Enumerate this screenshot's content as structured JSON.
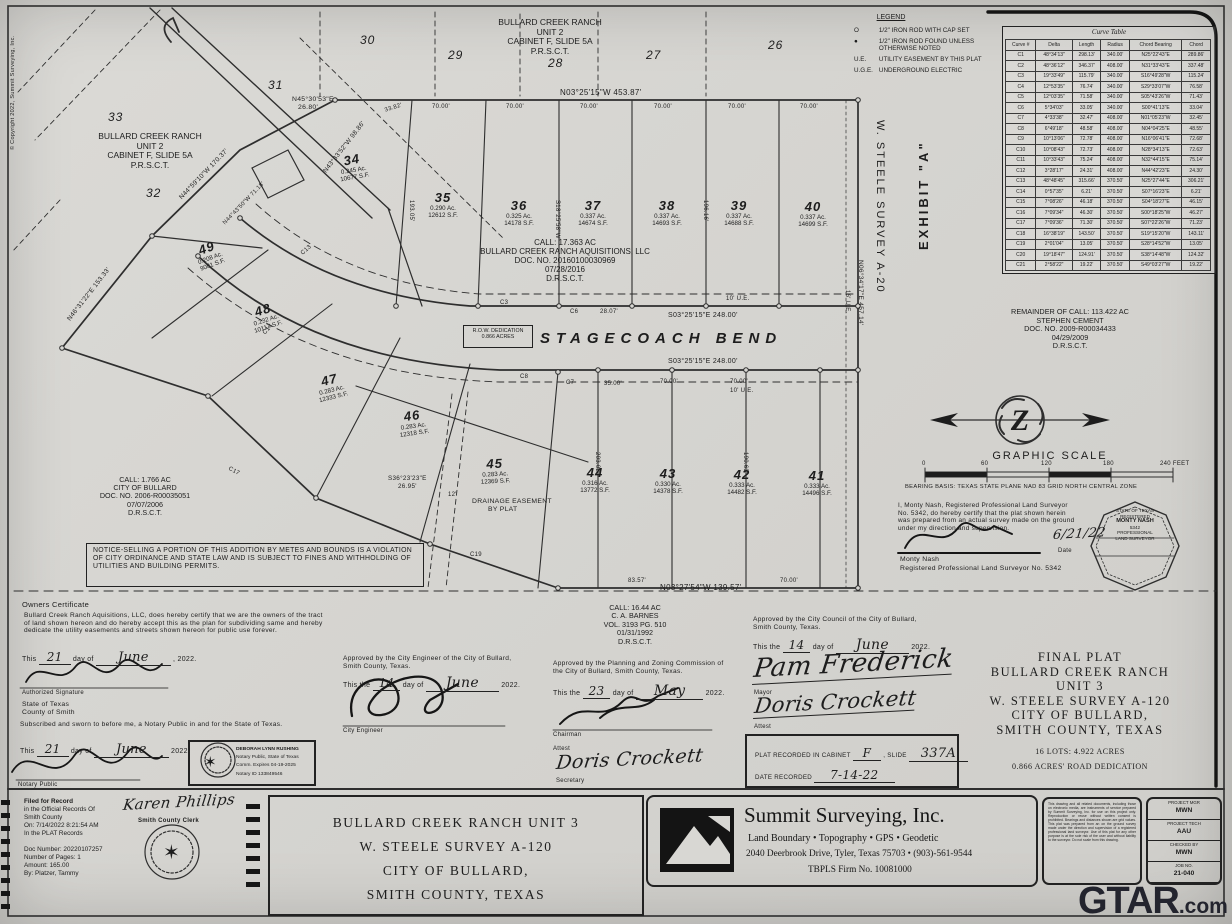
{
  "sheet": {
    "watermark_g": "GTAR",
    "watermark_dot": ".com",
    "copyright": "© Copyright 2022, Summit Surveying, Inc.",
    "exhibit": "EXHIBIT \"A\"",
    "survey": "W.  STEELE  SURVEY  A-20",
    "compass_letter": "Z"
  },
  "legend": {
    "title": "LEGEND",
    "rows": [
      [
        "O",
        "1/2\" IRON ROD WITH CAP SET"
      ],
      [
        "●",
        "1/2\" IRON ROD FOUND UNLESS OTHERWISE NOTED"
      ],
      [
        "U.E.",
        "UTILITY EASEMENT BY THIS PLAT"
      ],
      [
        "U.G.E.",
        "UNDERGROUND ELECTRIC"
      ]
    ]
  },
  "curve_table": {
    "title": "Curve Table",
    "headers": [
      "Curve #",
      "Delta",
      "Length",
      "Radius",
      "Chord Bearing",
      "Chord"
    ],
    "rows": [
      [
        "C1",
        "48°34'13\"",
        "298.13'",
        "340.00'",
        "N25°22'43\"E",
        "289.86'"
      ],
      [
        "C2",
        "48°36'12\"",
        "346.37'",
        "408.00'",
        "N31°33'43\"E",
        "337.48'"
      ],
      [
        "C3",
        "19°33'49\"",
        "115.79'",
        "340.00'",
        "S16°49'28\"W",
        "115.24'"
      ],
      [
        "C4",
        "12°53'35\"",
        "76.74'",
        "340.00'",
        "S29°33'07\"W",
        "76.58'"
      ],
      [
        "C5",
        "12°03'35\"",
        "71.58'",
        "340.00'",
        "S05°43'26\"W",
        "71.43'"
      ],
      [
        "C6",
        "5°34'03\"",
        "33.05'",
        "340.00'",
        "S00°41'13\"E",
        "33.04'"
      ],
      [
        "C7",
        "4°33'38\"",
        "32.47'",
        "408.00'",
        "N01°05'23\"W",
        "32.45'"
      ],
      [
        "C8",
        "6°49'18\"",
        "48.58'",
        "408.00'",
        "N04°04'25\"E",
        "48.55'"
      ],
      [
        "C9",
        "10°13'06\"",
        "72.78'",
        "408.00'",
        "N16°06'41\"E",
        "72.68'"
      ],
      [
        "C10",
        "10°08'43\"",
        "72.73'",
        "408.00'",
        "N28°34'13\"E",
        "72.63'"
      ],
      [
        "C11",
        "10°33'43\"",
        "75.24'",
        "408.00'",
        "N32°44'15\"E",
        "75.14'"
      ],
      [
        "C12",
        "3°28'17\"",
        "24.31'",
        "408.00'",
        "N44°42'23\"E",
        "24.30'"
      ],
      [
        "C13",
        "48°48'45\"",
        "315.66'",
        "370.50'",
        "N25°27'44\"E",
        "306.21'"
      ],
      [
        "C14",
        "0°57'35\"",
        "6.21'",
        "370.50'",
        "S07°16'23\"E",
        "6.21'"
      ],
      [
        "C15",
        "7°08'26\"",
        "46.18'",
        "370.50'",
        "S04°18'27\"E",
        "46.15'"
      ],
      [
        "C16",
        "7°09'34\"",
        "46.30'",
        "370.50'",
        "S00°18'25\"W",
        "46.27'"
      ],
      [
        "C17",
        "7°09'36\"",
        "71.30'",
        "370.50'",
        "S07°22'26\"W",
        "71.23'"
      ],
      [
        "C18",
        "16°38'19\"",
        "143.50'",
        "370.50'",
        "S19°15'20\"W",
        "143.11'"
      ],
      [
        "C19",
        "2°01'04\"",
        "13.05'",
        "370.50'",
        "S28°14'52\"W",
        "13.05'"
      ],
      [
        "C20",
        "19°18'47\"",
        "124.91'",
        "370.50'",
        "S38°14'48\"W",
        "124.32'"
      ],
      [
        "C21",
        "2°58'22\"",
        "19.22'",
        "370.50'",
        "S49°03'27\"W",
        "19.22'"
      ]
    ]
  },
  "unit2": {
    "name": "BULLARD CREEK RANCH",
    "unit": "UNIT 2",
    "cab": "CABINET F, SLIDE 5A",
    "rec": "P.R.S.C.T.",
    "lots": {
      "l26": "26",
      "l27": "27",
      "l28": "28",
      "l29": "29",
      "l30": "30",
      "l31": "31",
      "l32": "32",
      "l33": "33"
    }
  },
  "lots": [
    {
      "num": "34",
      "ac": "0.245 Ac.",
      "sf": "10677 S.F."
    },
    {
      "num": "35",
      "ac": "0.290 Ac.",
      "sf": "12612 S.F."
    },
    {
      "num": "36",
      "ac": "0.325 Ac.",
      "sf": "14178 S.F."
    },
    {
      "num": "37",
      "ac": "0.337 Ac.",
      "sf": "14674 S.F."
    },
    {
      "num": "38",
      "ac": "0.337 Ac.",
      "sf": "14693 S.F."
    },
    {
      "num": "39",
      "ac": "0.337 Ac.",
      "sf": "14688 S.F."
    },
    {
      "num": "40",
      "ac": "0.337 Ac.",
      "sf": "14699 S.F."
    },
    {
      "num": "41",
      "ac": "0.333 Ac.",
      "sf": "14496 S.F."
    },
    {
      "num": "42",
      "ac": "0.333 Ac.",
      "sf": "14482 S.F."
    },
    {
      "num": "43",
      "ac": "0.330 Ac.",
      "sf": "14378 S.F."
    },
    {
      "num": "44",
      "ac": "0.316 Ac.",
      "sf": "13772 S.F."
    },
    {
      "num": "45",
      "ac": "0.283 Ac.",
      "sf": "12369 S.F."
    },
    {
      "num": "46",
      "ac": "0.283 Ac.",
      "sf": "12318 S.F."
    },
    {
      "num": "47",
      "ac": "0.283 Ac.",
      "sf": "12333 S.F."
    },
    {
      "num": "48",
      "ac": "0.232 Ac.",
      "sf": "10117 S.F."
    },
    {
      "num": "49",
      "ac": "0.208 Ac.",
      "sf": "9081 S.F."
    }
  ],
  "street": {
    "name": "STAGECOACH  BEND",
    "row1": "R.O.W. DEDICATION",
    "row2": "0.866 ACRES"
  },
  "bearings": {
    "top": "N03°25'15\"W   453.87'",
    "bottom": "N03°27'54\"W   139.57'",
    "street_n": "S03°25'15\"E   248.00'",
    "street_s": "S03°25'15\"E   248.00'",
    "east": "N06°34'17\"E   457.14'",
    "ne1": "N45°30'53\"E",
    "ne1l": "26.80'",
    "nw1": "N43°33'52\"W  98.86'",
    "nw2": "N44°59'10\"W  170.37'",
    "sw": "N46°31'22\"E  153.33'",
    "l7118": "N44°43'50\"W  71.18'",
    "se1": "S36°23'23\"E",
    "se1l": "26.95'",
    "div1": "S18°25'58\"W",
    "d193": "193.05'",
    "d196": "196.16'",
    "d203": "203.02'",
    "d190": "190.63'"
  },
  "dims": {
    "d70": "70.00'",
    "d2807": "28.07'",
    "d35": "35.00'",
    "d8357": "83.57'",
    "d3382": "33.82'",
    "ue10": "10' U.E.",
    "ue16": "16' U.E.",
    "d12": "12'"
  },
  "curves": {
    "c3": "C3",
    "c6": "C6",
    "c7": "C7",
    "c8": "C8",
    "c13": "C13",
    "c14": "C14",
    "c17": "C17",
    "c19": "C19"
  },
  "calls": {
    "acq": [
      "CALL:  17.363 AC",
      "BULLARD CREEK RANCH AQUISITIONS, LLC",
      "DOC. NO. 20160100030969",
      "07/28/2016",
      "D.R.S.C.T."
    ],
    "bullard": [
      "CALL:  1.766 AC",
      "CITY OF BULLARD",
      "DOC. NO. 2006-R00035051",
      "07/07/2006",
      "D.R.S.C.T."
    ],
    "barnes": [
      "CALL:  16.44 AC",
      "C. A. BARNES",
      "VOL. 3193 PG. 510",
      "01/31/1992",
      "D.R.S.C.T."
    ],
    "remainder": [
      "REMAINDER OF CALL:  113.422 AC",
      "STEPHEN CEMENT",
      "DOC. NO. 2009-R00034433",
      "04/29/2009",
      "D.R.S.C.T."
    ]
  },
  "easement": {
    "l1": "DRAINAGE EASEMENT",
    "l2": "BY PLAT"
  },
  "notice": "NOTICE-SELLING A PORTION OF THIS ADDITION BY METES AND BOUNDS IS A VIOLATION OF CITY ORDINANCE AND STATE LAW AND IS SUBJECT TO FINES AND WITHHOLDING OF UTILITIES AND BUILDING PERMITS.",
  "scale": {
    "title": "GRAPHIC SCALE",
    "t0": "0",
    "t60": "60",
    "t120": "120",
    "t180": "180",
    "t240": "240 FEET",
    "basis": "BEARING BASIS: TEXAS STATE PLANE NAD 83 GRID NORTH CENTRAL ZONE"
  },
  "surveyor": {
    "cert": "I, Monty Nash, Registered Professional Land Surveyor No. 5342, do hereby certify that the plat shown herein was prepared from an actual survey made on the ground under my direction and supervision.",
    "date": "6/21/22",
    "date_label": "Date",
    "name": "Monty Nash",
    "title": "Registered Professional Land Surveyor No. 5342",
    "seal": [
      "STATE OF TEXAS",
      "REGISTERED",
      "MONTY NASH",
      "5342",
      "PROFESSIONAL",
      "LAND SURVEYOR"
    ]
  },
  "certs": {
    "owner": {
      "heading": "Owners Certificate",
      "body": "Bullard Creek Ranch Aquisitions, LLC, does hereby certify that we are the owners of the tract of land shown hereon and do hereby accept this as the plan for subdividing same and hereby dedicate the utility easements and streets shown hereon for public use forever.",
      "d1": "This",
      "day": "21",
      "d2": "day of",
      "month": "June",
      "d3": ", 2022.",
      "sig_label": "Authorized Signature",
      "state": "State of Texas",
      "county": "County of Smith",
      "notary_body": "Subscribed and sworn to before me, a Notary Public in and for the State of Texas.",
      "n1": "This",
      "nday": "21",
      "n2": "day of",
      "nmonth": "June",
      "n3": "2022.",
      "notary_label": "Notary Public"
    },
    "stamp": [
      "DEBORAH LYNN RUSHING",
      "Notary Public, State of Texas",
      "Comm. Expires 04-19-2025",
      "Notary ID 133849546"
    ],
    "engineer": {
      "l1": "Approved by the City Engineer of the City of Bullard,",
      "l2": "Smith County, Texas.",
      "d1": "This the",
      "day": "14",
      "d2": "day of",
      "month": "June",
      "d3": "2022.",
      "label": "City Engineer"
    },
    "pz": {
      "l1": "Approved by the Planning and Zoning Commission of",
      "l2": "the City of Bullard, Smith County, Texas.",
      "d1": "This the",
      "day": "23",
      "d2": "day of",
      "month": "May",
      "d3": "2022.",
      "label": "Chairman",
      "attest": "Attest",
      "secretary": "Doris Crockett",
      "sec_label": "Secretary"
    },
    "council": {
      "l1": "Approved by the City Council of the City of Bullard,",
      "l2": "Smith County, Texas.",
      "d1": "This the",
      "day": "14",
      "d2": "day of",
      "month": "June",
      "d3": "2022.",
      "mayor_sig": "Pam Frederick",
      "mayor_label": "Mayor",
      "attest_sig": "Doris Crockett",
      "attest_label": "Attest"
    },
    "recorded": {
      "l1": "PLAT RECORDED IN CABINET",
      "cab": "F",
      "l2": ", SLIDE",
      "slide": "337A",
      "l3": "DATE RECORDED",
      "date": "7-14-22"
    }
  },
  "title_block": {
    "l1": "FINAL PLAT",
    "l2": "BULLARD CREEK RANCH UNIT 3",
    "l3": "W. STEELE SURVEY A-120",
    "l4": "CITY OF BULLARD,",
    "l5": "SMITH COUNTY, TEXAS",
    "s1": "16 LOTS: 4.922 ACRES",
    "s2": "0.866 ACRES' ROAD DEDICATION"
  },
  "footer": {
    "filed": {
      "lines": [
        "Filed for Record",
        "in the Official Records Of",
        "Smith County",
        "On: 7/14/2022 8:21:54 AM",
        "In the PLAT Records"
      ],
      "lines2": [
        "Doc Number: 20220107257",
        "Number of Pages: 1",
        "Amount: 165.00",
        "By: Platzer, Tammy"
      ],
      "clerk_sig": "Karen Phillips",
      "clerk_label": "Smith County Clerk"
    },
    "unit3_box": [
      "BULLARD CREEK RANCH UNIT 3",
      "W. STEELE SURVEY A-120",
      "CITY OF BULLARD,",
      "SMITH COUNTY, TEXAS"
    ],
    "summit": {
      "name": "Summit Surveying, Inc.",
      "services": "Land Boundary • Topography • GPS • Geodetic",
      "address": "2040 Deerbrook Drive, Tyler, Texas 75703 • (903)-561-9544",
      "firm": "TBPLS Firm No. 10081000"
    },
    "fine_print": "This drawing and all related documents, including those on electronic media, are instruments of service prepared by Summit Surveying, Inc. for use on this project only. Reproduction or reuse without written consent is prohibited. Bearings and distances shown are grid values. This plat was prepared from an on the ground survey made under the direction and supervision of a registered professional land surveyor. Use of this plat for any other purpose is at the sole risk of the user and without liability to the surveyor. Do not scale from this drawing.",
    "project": [
      [
        "PROJECT MGR",
        "MWN"
      ],
      [
        "PROJECT TECH",
        "AAU"
      ],
      [
        "CHECKED BY",
        "MWN"
      ],
      [
        "JOB NO.",
        "21-040"
      ]
    ]
  }
}
